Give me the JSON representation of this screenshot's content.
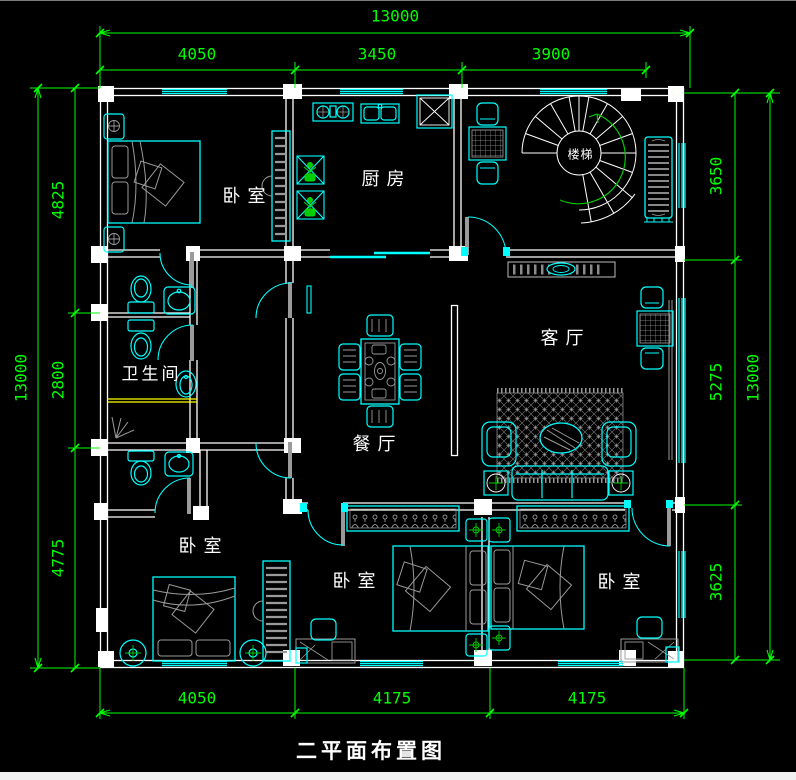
{
  "colors": {
    "background": "#000000",
    "wall": "#ffffff",
    "furniture": "#00ffff",
    "dimension": "#00ff00",
    "detail_gray": "#9a9a9a",
    "highlight_yellow": "#ffff00",
    "label": "#ffffff"
  },
  "title": {
    "text": "二平面布置图"
  },
  "rooms": {
    "bedroom_top_left": "卧室",
    "kitchen": "厨房",
    "staircase": "楼梯",
    "bathroom": "卫生间",
    "dining_room": "餐厅",
    "living_room": "客厅",
    "bedroom_bottom_left": "卧室",
    "bedroom_bottom_middle": "卧室",
    "bedroom_bottom_right": "卧室"
  },
  "dimensions": {
    "top_total": "13000",
    "top_segments": [
      "4050",
      "3450",
      "3900"
    ],
    "bottom_segments": [
      "4050",
      "4175",
      "4175"
    ],
    "left_total": "13000",
    "left_segments": [
      "4825",
      "2800",
      "4775"
    ],
    "right_total": "13000",
    "right_segments": [
      "3650",
      "5275",
      "3625"
    ]
  }
}
